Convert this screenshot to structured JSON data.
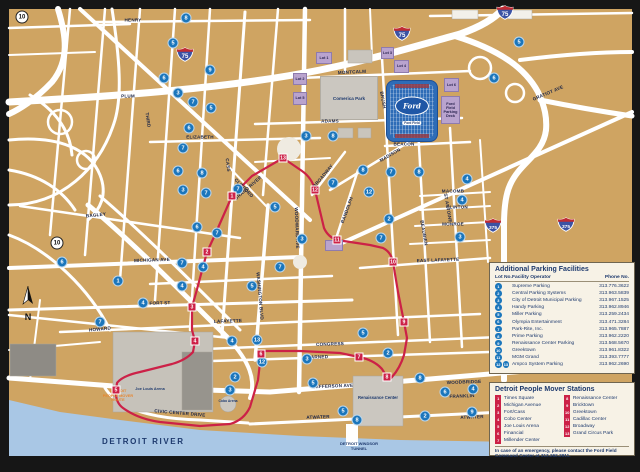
{
  "colors": {
    "map_tan": "#CFA462",
    "water": "#A9C7E5",
    "route_red": "#CC2147",
    "lot_blue": "#1B76BC",
    "purple": "#B9A3CE",
    "navy": "#1E3A6E",
    "cream": "#F7F2E6",
    "shield_blue": "#3B52A4",
    "shield_red": "#BF2B33",
    "ford_blue": "#2E6CB7",
    "frame_black": "#161616"
  },
  "map": {
    "compass": "N",
    "river": "DETROIT RIVER",
    "tunnel_line1": "DETROIT WINDSOR",
    "tunnel_line2": "TUNNEL",
    "route_note_line1": "DETROIT",
    "route_note_line2": "PEOPLE MOVER",
    "route_note_line3": "ROUTE",
    "places": {
      "comerica": "Comerica Park",
      "ford_oval": "Ford",
      "ford_banner": "Ford Field",
      "joe_louis": "Joe Louis Arena",
      "cobo_arena": "Cobo Arena",
      "renaissance": "Renaissance Center"
    },
    "shields": [
      {
        "type": "circle",
        "num": "10",
        "x": 22,
        "y": 17
      },
      {
        "type": "circle",
        "num": "10",
        "x": 57,
        "y": 243
      },
      {
        "type": "int",
        "num": "75",
        "x": 185,
        "y": 57
      },
      {
        "type": "int",
        "num": "75",
        "x": 402,
        "y": 36
      },
      {
        "type": "int",
        "num": "75",
        "x": 505,
        "y": 15
      },
      {
        "type": "int",
        "num": "375",
        "x": 493,
        "y": 228
      },
      {
        "type": "int",
        "num": "375",
        "x": 566,
        "y": 227
      }
    ],
    "street_labels": [
      {
        "t": "HENRY",
        "x": 133,
        "y": 20,
        "r": 0
      },
      {
        "t": "PLUM",
        "x": 128,
        "y": 96,
        "r": 0
      },
      {
        "t": "ELIZABETH",
        "x": 200,
        "y": 137,
        "r": 0
      },
      {
        "t": "ADAMS",
        "x": 330,
        "y": 121,
        "r": 0
      },
      {
        "t": "MONTCALM",
        "x": 352,
        "y": 72,
        "r": -3
      },
      {
        "t": "BEACON",
        "x": 404,
        "y": 144,
        "r": 0
      },
      {
        "t": "BRUSH",
        "x": 383,
        "y": 100,
        "r": 80
      },
      {
        "t": "MADISON",
        "x": 390,
        "y": 155,
        "r": -30
      },
      {
        "t": "BROADWAY",
        "x": 323,
        "y": 176,
        "r": -50
      },
      {
        "t": "RANDOLPH",
        "x": 347,
        "y": 210,
        "r": -70
      },
      {
        "t": "GRATIOT AVE",
        "x": 548,
        "y": 93,
        "r": -23
      },
      {
        "t": "GRAND RIVER",
        "x": 248,
        "y": 188,
        "r": -41
      },
      {
        "t": "WOODWARD AVE",
        "x": 297,
        "y": 228,
        "r": 88
      },
      {
        "t": "WASHINGTON BLVD",
        "x": 260,
        "y": 296,
        "r": 85
      },
      {
        "t": "CASS",
        "x": 228,
        "y": 165,
        "r": 82
      },
      {
        "t": "THIRD",
        "x": 148,
        "y": 120,
        "r": 82
      },
      {
        "t": "CLIFFORD",
        "x": 244,
        "y": 188,
        "r": 46
      },
      {
        "t": "BAGLEY",
        "x": 96,
        "y": 215,
        "r": -6
      },
      {
        "t": "MICHIGAN AVE",
        "x": 152,
        "y": 260,
        "r": -2
      },
      {
        "t": "FORT ST",
        "x": 160,
        "y": 303,
        "r": -2
      },
      {
        "t": "LAFAYETTE",
        "x": 228,
        "y": 321,
        "r": -2
      },
      {
        "t": "HOWARD",
        "x": 100,
        "y": 329,
        "r": -6
      },
      {
        "t": "CONGRESS",
        "x": 330,
        "y": 344,
        "r": -2
      },
      {
        "t": "LARNED",
        "x": 318,
        "y": 357,
        "r": -2
      },
      {
        "t": "JEFFERSON AVE",
        "x": 333,
        "y": 386,
        "r": -2
      },
      {
        "t": "ATWATER",
        "x": 318,
        "y": 417,
        "r": -2
      },
      {
        "t": "CIVIC CENTER DRIVE",
        "x": 180,
        "y": 413,
        "r": 5
      },
      {
        "t": "MACOMB",
        "x": 453,
        "y": 191,
        "r": 0
      },
      {
        "t": "CLINTON",
        "x": 457,
        "y": 207,
        "r": 0
      },
      {
        "t": "MONROE",
        "x": 453,
        "y": 224,
        "r": 0
      },
      {
        "t": "EAST LAFAYETTE",
        "x": 438,
        "y": 260,
        "r": -2
      },
      {
        "t": "ST ANTOINE",
        "x": 448,
        "y": 208,
        "r": 80
      },
      {
        "t": "BEAUBIEN",
        "x": 424,
        "y": 233,
        "r": 80
      },
      {
        "t": "WOODBRIDGE",
        "x": 464,
        "y": 382,
        "r": -2
      },
      {
        "t": "FRANKLIN",
        "x": 462,
        "y": 396,
        "r": -2
      },
      {
        "t": "ATWATER",
        "x": 472,
        "y": 417,
        "r": -2
      }
    ],
    "purple_lots": [
      {
        "t": "Lot 1",
        "x": 316,
        "y": 52,
        "w": 16,
        "h": 12
      },
      {
        "t": "Lot 2",
        "x": 293,
        "y": 73,
        "w": 14,
        "h": 12
      },
      {
        "t": "Lot 5",
        "x": 293,
        "y": 92,
        "w": 14,
        "h": 13
      },
      {
        "t": "Lot 3",
        "x": 381,
        "y": 47,
        "w": 13,
        "h": 12
      },
      {
        "t": "Lot 4",
        "x": 394,
        "y": 60,
        "w": 15,
        "h": 13
      },
      {
        "t": "Lot 6",
        "x": 444,
        "y": 78,
        "w": 15,
        "h": 14
      },
      {
        "t": "Ford Field Parking Deck",
        "x": 441,
        "y": 96,
        "w": 19,
        "h": 28
      },
      {
        "t": "",
        "x": 325,
        "y": 240,
        "w": 18,
        "h": 11
      }
    ],
    "stations": [
      {
        "n": 1,
        "x": 232,
        "y": 196
      },
      {
        "n": 2,
        "x": 207,
        "y": 252
      },
      {
        "n": 3,
        "x": 192,
        "y": 307
      },
      {
        "n": 4,
        "x": 195,
        "y": 341
      },
      {
        "n": 5,
        "x": 116,
        "y": 390
      },
      {
        "n": 6,
        "x": 261,
        "y": 354
      },
      {
        "n": 7,
        "x": 359,
        "y": 357
      },
      {
        "n": 8,
        "x": 387,
        "y": 377
      },
      {
        "n": 9,
        "x": 404,
        "y": 322
      },
      {
        "n": 10,
        "x": 393,
        "y": 262
      },
      {
        "n": 11,
        "x": 337,
        "y": 240
      },
      {
        "n": 12,
        "x": 315,
        "y": 190
      },
      {
        "n": 13,
        "x": 283,
        "y": 158
      }
    ],
    "lot_markers": [
      {
        "n": 8,
        "x": 186,
        "y": 18
      },
      {
        "n": 5,
        "x": 173,
        "y": 43
      },
      {
        "n": 9,
        "x": 210,
        "y": 70
      },
      {
        "n": 6,
        "x": 164,
        "y": 78
      },
      {
        "n": 3,
        "x": 178,
        "y": 93
      },
      {
        "n": 7,
        "x": 193,
        "y": 102
      },
      {
        "n": 5,
        "x": 211,
        "y": 108
      },
      {
        "n": 6,
        "x": 189,
        "y": 128
      },
      {
        "n": 7,
        "x": 183,
        "y": 148
      },
      {
        "n": 3,
        "x": 306,
        "y": 136
      },
      {
        "n": 8,
        "x": 333,
        "y": 136
      },
      {
        "n": 8,
        "x": 363,
        "y": 170
      },
      {
        "n": 7,
        "x": 391,
        "y": 172
      },
      {
        "n": 8,
        "x": 419,
        "y": 172
      },
      {
        "n": 7,
        "x": 333,
        "y": 183
      },
      {
        "n": 12,
        "x": 369,
        "y": 192
      },
      {
        "n": 2,
        "x": 389,
        "y": 219
      },
      {
        "n": 7,
        "x": 381,
        "y": 238
      },
      {
        "n": 3,
        "x": 302,
        "y": 239
      },
      {
        "n": 6,
        "x": 178,
        "y": 171
      },
      {
        "n": 8,
        "x": 202,
        "y": 173
      },
      {
        "n": 3,
        "x": 183,
        "y": 190
      },
      {
        "n": 7,
        "x": 206,
        "y": 193
      },
      {
        "n": 7,
        "x": 238,
        "y": 189
      },
      {
        "n": 5,
        "x": 275,
        "y": 207
      },
      {
        "n": 6,
        "x": 197,
        "y": 227
      },
      {
        "n": 7,
        "x": 217,
        "y": 233
      },
      {
        "n": 7,
        "x": 182,
        "y": 263
      },
      {
        "n": 4,
        "x": 203,
        "y": 267
      },
      {
        "n": 7,
        "x": 280,
        "y": 267
      },
      {
        "n": 5,
        "x": 252,
        "y": 286
      },
      {
        "n": 4,
        "x": 182,
        "y": 286
      },
      {
        "n": 6,
        "x": 62,
        "y": 262
      },
      {
        "n": 1,
        "x": 118,
        "y": 281
      },
      {
        "n": 4,
        "x": 143,
        "y": 303
      },
      {
        "n": 7,
        "x": 100,
        "y": 322
      },
      {
        "n": 5,
        "x": 519,
        "y": 42
      },
      {
        "n": 6,
        "x": 494,
        "y": 78
      },
      {
        "n": 4,
        "x": 467,
        "y": 179
      },
      {
        "n": 4,
        "x": 462,
        "y": 200
      },
      {
        "n": 3,
        "x": 460,
        "y": 237
      },
      {
        "n": 4,
        "x": 232,
        "y": 341
      },
      {
        "n": 13,
        "x": 257,
        "y": 340
      },
      {
        "n": 12,
        "x": 262,
        "y": 362
      },
      {
        "n": 2,
        "x": 235,
        "y": 377
      },
      {
        "n": 3,
        "x": 230,
        "y": 390
      },
      {
        "n": 3,
        "x": 307,
        "y": 359
      },
      {
        "n": 5,
        "x": 313,
        "y": 383
      },
      {
        "n": 2,
        "x": 388,
        "y": 353
      },
      {
        "n": 5,
        "x": 363,
        "y": 333
      },
      {
        "n": 8,
        "x": 420,
        "y": 378
      },
      {
        "n": 5,
        "x": 343,
        "y": 411
      },
      {
        "n": 8,
        "x": 357,
        "y": 420
      },
      {
        "n": 2,
        "x": 425,
        "y": 416
      },
      {
        "n": 6,
        "x": 445,
        "y": 392
      },
      {
        "n": 9,
        "x": 472,
        "y": 412
      },
      {
        "n": 4,
        "x": 473,
        "y": 389
      }
    ]
  },
  "legend_parking": {
    "title": "Additional Parking Facilities",
    "col_lot": "Lot No.",
    "col_facility": "Facility Operator",
    "col_phone": "Phone No.",
    "rows": [
      {
        "lots": [
          1
        ],
        "facility": "Supreme Parking",
        "phone": "313.776.3622"
      },
      {
        "lots": [
          2
        ],
        "facility": "Central Parking Systems",
        "phone": "313.963.5839"
      },
      {
        "lots": [
          3
        ],
        "facility": "City of Detroit Municipal Parking",
        "phone": "313.967.1525"
      },
      {
        "lots": [
          4
        ],
        "facility": "Handy Parking",
        "phone": "313.962.8946"
      },
      {
        "lots": [
          5
        ],
        "facility": "Miller Parking",
        "phone": "313.259.2434"
      },
      {
        "lots": [
          6
        ],
        "facility": "Olympia Entertainment",
        "phone": "313.471.3284"
      },
      {
        "lots": [
          7
        ],
        "facility": "Park-Rite, Inc.",
        "phone": "313.965.7887"
      },
      {
        "lots": [
          8
        ],
        "facility": "Prime Parking",
        "phone": "313.962.2220"
      },
      {
        "lots": [
          9
        ],
        "facility": "Renaissance Center Parking",
        "phone": "313.568.5670"
      },
      {
        "lots": [
          10
        ],
        "facility": "Greektown",
        "phone": "313.961.8322"
      },
      {
        "lots": [
          11
        ],
        "facility": "MGM Grand",
        "phone": "313.393.7777"
      },
      {
        "lots": [
          12,
          13
        ],
        "facility": "Ampco System Parking",
        "phone": "313.962.2690"
      }
    ]
  },
  "legend_mover": {
    "title": "Detroit People Mover Stations",
    "stations": [
      {
        "n": 1,
        "name": "Times Square"
      },
      {
        "n": 2,
        "name": "Michigan Avenue"
      },
      {
        "n": 3,
        "name": "Fort/Cass"
      },
      {
        "n": 4,
        "name": "Cobo Center"
      },
      {
        "n": 5,
        "name": "Joe Louis Arena"
      },
      {
        "n": 6,
        "name": "Financial"
      },
      {
        "n": 7,
        "name": "Millender Center"
      },
      {
        "n": 8,
        "name": "Renaissance Center"
      },
      {
        "n": 9,
        "name": "Bricktown"
      },
      {
        "n": 10,
        "name": "Greektown"
      },
      {
        "n": 11,
        "name": "Cadillac Center"
      },
      {
        "n": 12,
        "name": "Broadway"
      },
      {
        "n": 13,
        "name": "Grand Circus Park"
      }
    ],
    "note": "In case of an emergency, please contact the Ford Field Command Center at 313.262.2911."
  }
}
